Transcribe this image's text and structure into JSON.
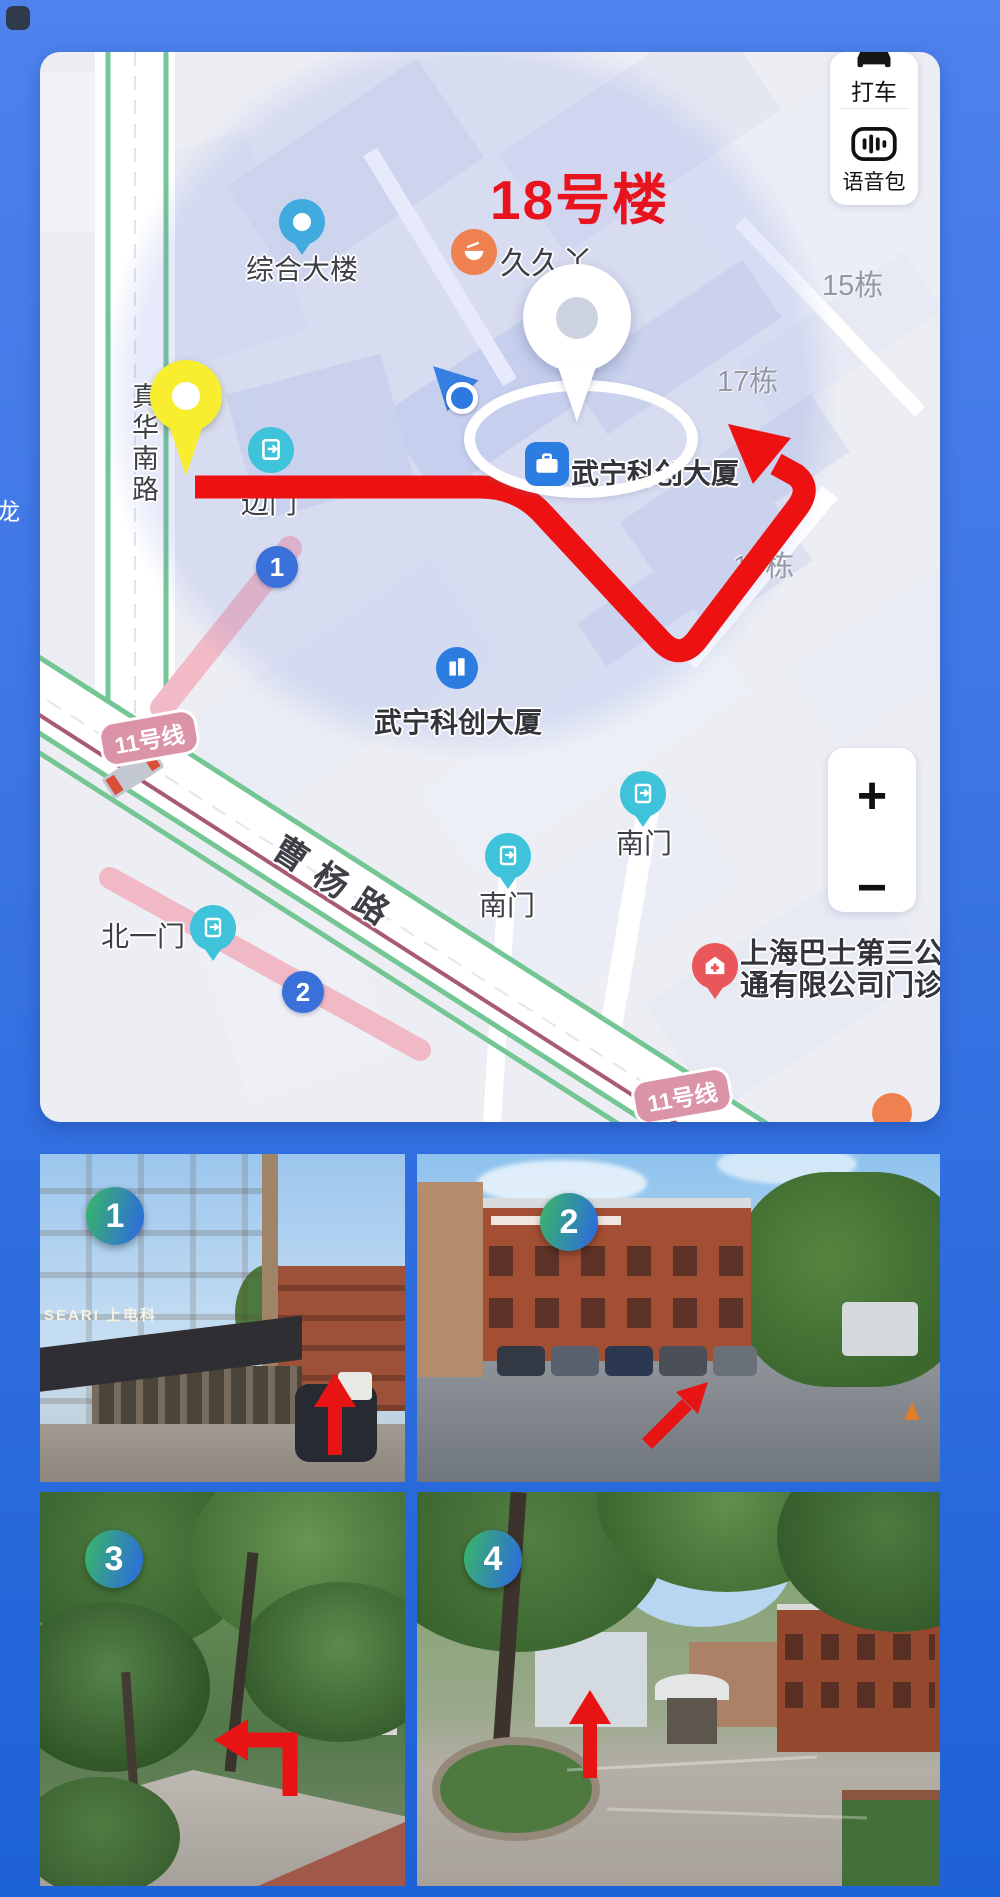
{
  "page": {
    "bg_top": "#4e82ec",
    "bg_bottom": "#1d62d6",
    "edge_glyph": "龙"
  },
  "map": {
    "title": "18号楼",
    "controls": {
      "taxi_label": "打车",
      "voice_label": "语音包",
      "zoom_in": "+",
      "zoom_out": "−"
    },
    "pois": [
      {
        "text": "综合大楼"
      },
      {
        "text": "久久丫"
      },
      {
        "text": "武宁科创大厦"
      },
      {
        "text": "边门"
      },
      {
        "text": "武宁科创大厦"
      },
      {
        "text": "南门"
      },
      {
        "text": "南门"
      },
      {
        "text": "北一门"
      },
      {
        "text": "上海巴士第三公",
        "text2": "通有限公司门诊"
      }
    ],
    "building_labels": [
      {
        "text": "15栋"
      },
      {
        "text": "17栋"
      },
      {
        "text": "19栋"
      }
    ],
    "road_labels": {
      "vertical": "真华南路",
      "diagonal": "曹杨路"
    },
    "metro_line_badge": "11号线",
    "route_markers": [
      {
        "n": "1"
      },
      {
        "n": "2"
      }
    ],
    "colors": {
      "route_red": "#ee1111",
      "title_red": "#e8131d",
      "marker_blue": "#3a70da",
      "metro_badge_pink": "#db93a8",
      "highlight": "rgba(108,132,224,0.17)",
      "poi_teal": "#3ec3da",
      "pin_yellow": "#f8ee2f"
    }
  },
  "photos": [
    {
      "number": "1",
      "sign": "SEARI 上电科",
      "arrow": "up"
    },
    {
      "number": "2",
      "arrow": "up-right"
    },
    {
      "number": "3",
      "arrow": "up-then-left"
    },
    {
      "number": "4",
      "arrow": "up"
    }
  ]
}
